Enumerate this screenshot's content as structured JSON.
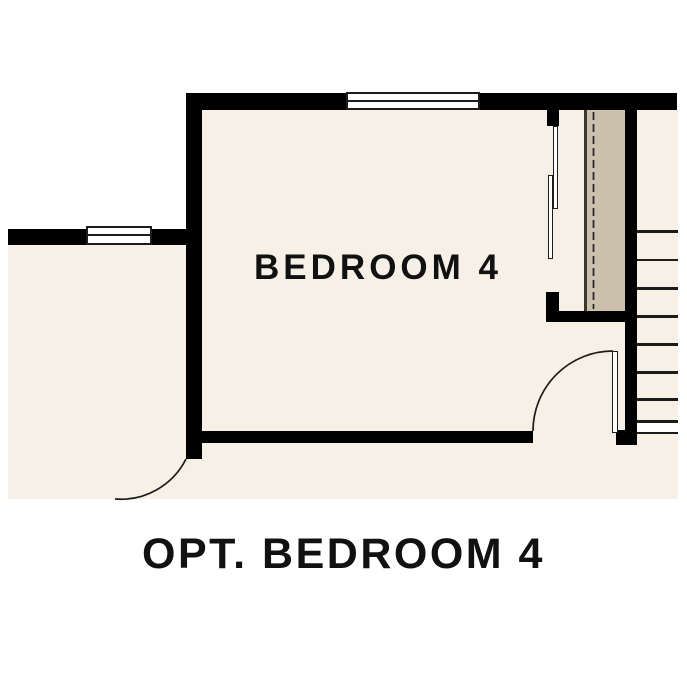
{
  "room": {
    "label": "BEDROOM 4"
  },
  "caption": {
    "label": "OPT. BEDROOM 4"
  },
  "colors": {
    "wall": "#000000",
    "floor": "#f6f0e6",
    "closet": "#cbc0ab",
    "line": "#1c1c1c",
    "bg": "#ffffff",
    "text": "#111111"
  },
  "symbols": {
    "windows": [
      {
        "name": "window-top",
        "type": "double-line-window"
      },
      {
        "name": "window-left",
        "type": "double-line-window"
      }
    ],
    "doors": [
      {
        "name": "bedroom-entry-door",
        "type": "hinged-swing-door"
      },
      {
        "name": "hall-door",
        "type": "hinged-swing-door"
      },
      {
        "name": "closet-bypass-doors",
        "type": "sliding-bypass-door",
        "panels": 2
      }
    ],
    "closet": {
      "rod": "dashed-line",
      "shelf_edge": "solid-line"
    },
    "stairs": {
      "treads_visible": 9
    }
  }
}
